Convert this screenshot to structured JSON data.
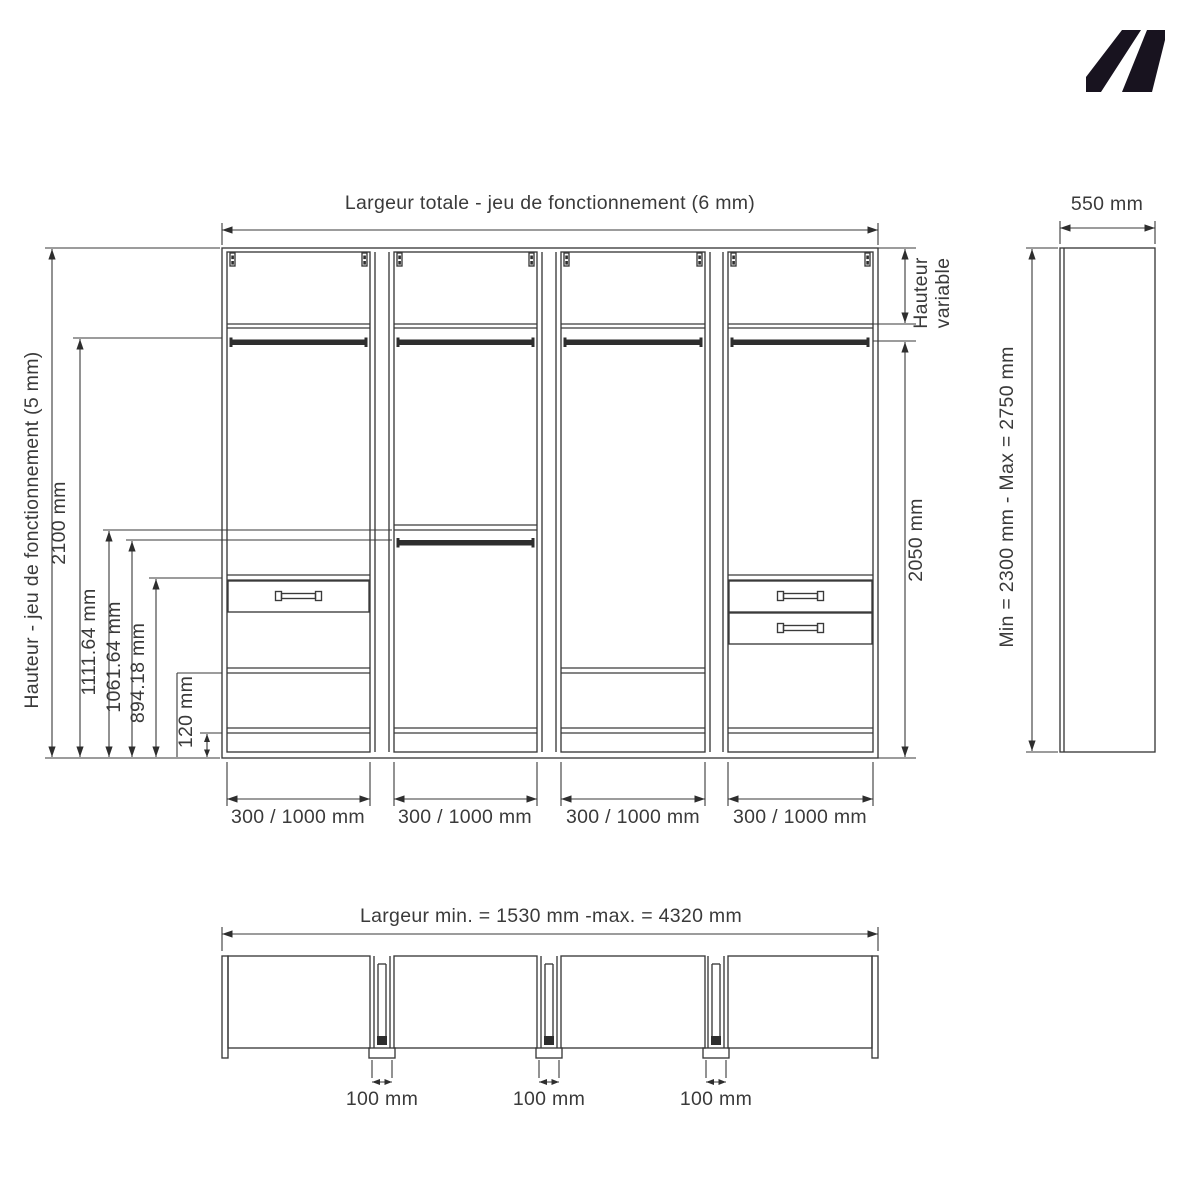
{
  "page": {
    "background": "#ffffff",
    "line_color": "#3a3a3a",
    "text_color": "#3a3a3a"
  },
  "logo": {
    "name": "kz-brand-mark",
    "color": "#18131f"
  },
  "front_view": {
    "dim_total_width": "Largeur totale - jeu de fonctionnement (6 mm)",
    "dim_overall_height": "Hauteur - jeu de fonctionnement (5 mm)",
    "dim_2100": "2100 mm",
    "dim_1111": "1111.64 mm",
    "dim_1061": "1061.64 mm",
    "dim_894": "894.18 mm",
    "dim_120": "120 mm",
    "dim_hauteur_variable_line1": "Hauteur",
    "dim_hauteur_variable_line2": "variable",
    "dim_2050": "2050 mm",
    "section_width_dims": [
      "300 / 1000 mm",
      "300 / 1000 mm",
      "300 / 1000 mm",
      "300 / 1000 mm"
    ]
  },
  "side_view": {
    "dim_depth": "550 mm",
    "dim_height_range": "Min = 2300 mm - Max = 2750 mm"
  },
  "plan_view": {
    "dim_width_range": "Largeur min. = 1530 mm -max. = 4320 mm",
    "dim_gaps": [
      "100 mm",
      "100 mm",
      "100 mm"
    ]
  }
}
